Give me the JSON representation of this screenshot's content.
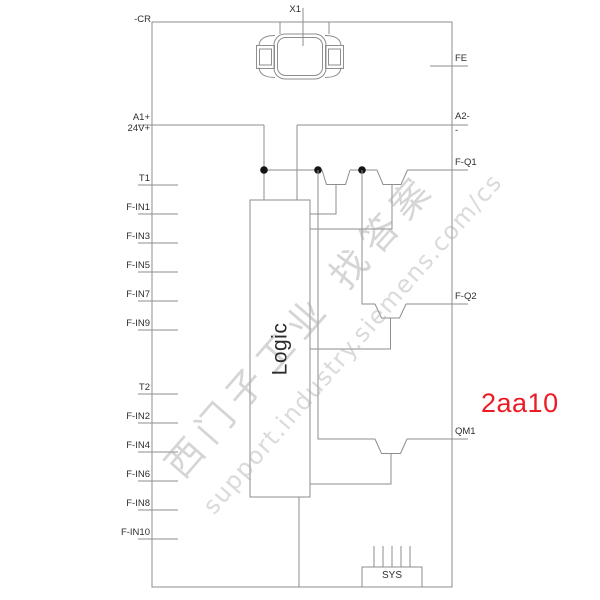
{
  "labels": {
    "device_designation": "-CR",
    "connector_top": "X1",
    "logic": "Logic",
    "sys": "SYS"
  },
  "annotation": {
    "text": "2aa10",
    "color": "#ec1c24"
  },
  "power_left": {
    "line1": "A1+",
    "line2": "24V+"
  },
  "left_pins": [
    {
      "label": "T1"
    },
    {
      "label": "F-IN1"
    },
    {
      "label": "F-IN3"
    },
    {
      "label": "F-IN5"
    },
    {
      "label": "F-IN7"
    },
    {
      "label": "F-IN9"
    },
    {
      "label": "T2"
    },
    {
      "label": "F-IN2"
    },
    {
      "label": "F-IN4"
    },
    {
      "label": "F-IN6"
    },
    {
      "label": "F-IN8"
    },
    {
      "label": "F-IN10"
    }
  ],
  "right_pins": [
    {
      "label": "FE"
    },
    {
      "label": "A2-",
      "sublabel": "-"
    },
    {
      "label": "F-Q1"
    },
    {
      "label": "F-Q2"
    },
    {
      "label": "QM1"
    }
  ],
  "watermark": {
    "line1": "西门子工业 找答案",
    "line2": "support.industry.siemens.com/cs"
  },
  "colors": {
    "line": "#8e8e8e",
    "dot": "#151515",
    "text": "#2e2e2e"
  }
}
